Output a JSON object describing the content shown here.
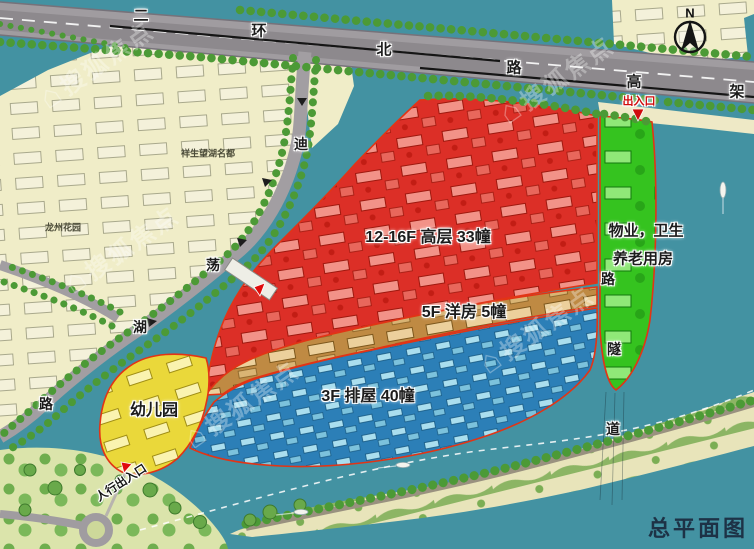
{
  "title": "总平面图",
  "compass_label": "N",
  "watermark": {
    "icon": "⌂",
    "text": "搜狐焦点"
  },
  "roads": {
    "ring": {
      "name": "二环北路高架",
      "chars": [
        "二",
        "环",
        "北",
        "路",
        "高",
        "架"
      ]
    },
    "didang": {
      "name": "迪荡湖路",
      "chars": [
        "迪",
        "荡",
        "湖",
        "路"
      ]
    },
    "tunnel": {
      "name": "路隧道",
      "chars": [
        "路",
        "隧",
        "道"
      ]
    }
  },
  "zones": {
    "highrise": {
      "label": "12-16F 高层 33幢",
      "color": "#dc2f27"
    },
    "garden_house": {
      "label": "5F 洋房 5幢",
      "color": "#bf8a43"
    },
    "rowhouse": {
      "label": "3F 排屋 40幢",
      "color": "#2c7fb7"
    },
    "kindergarten": {
      "label": "幼儿园",
      "color": "#ead83a"
    },
    "facility": {
      "line1": "物业，卫生",
      "line2": "养老用房",
      "color": "#35c31f"
    }
  },
  "markers": {
    "north_entrance": "出入口",
    "pedestrian_entrance": "人行出入口"
  },
  "places": {
    "estate": "祥生望湖名都",
    "garden": "龙州花园"
  },
  "colors": {
    "water": "#4392a2",
    "land": "#f0edc8",
    "road": "#a09ca0",
    "site_boundary": "#e23415",
    "title_text": "#1d3246",
    "entrance_text": "#d00c0c"
  }
}
